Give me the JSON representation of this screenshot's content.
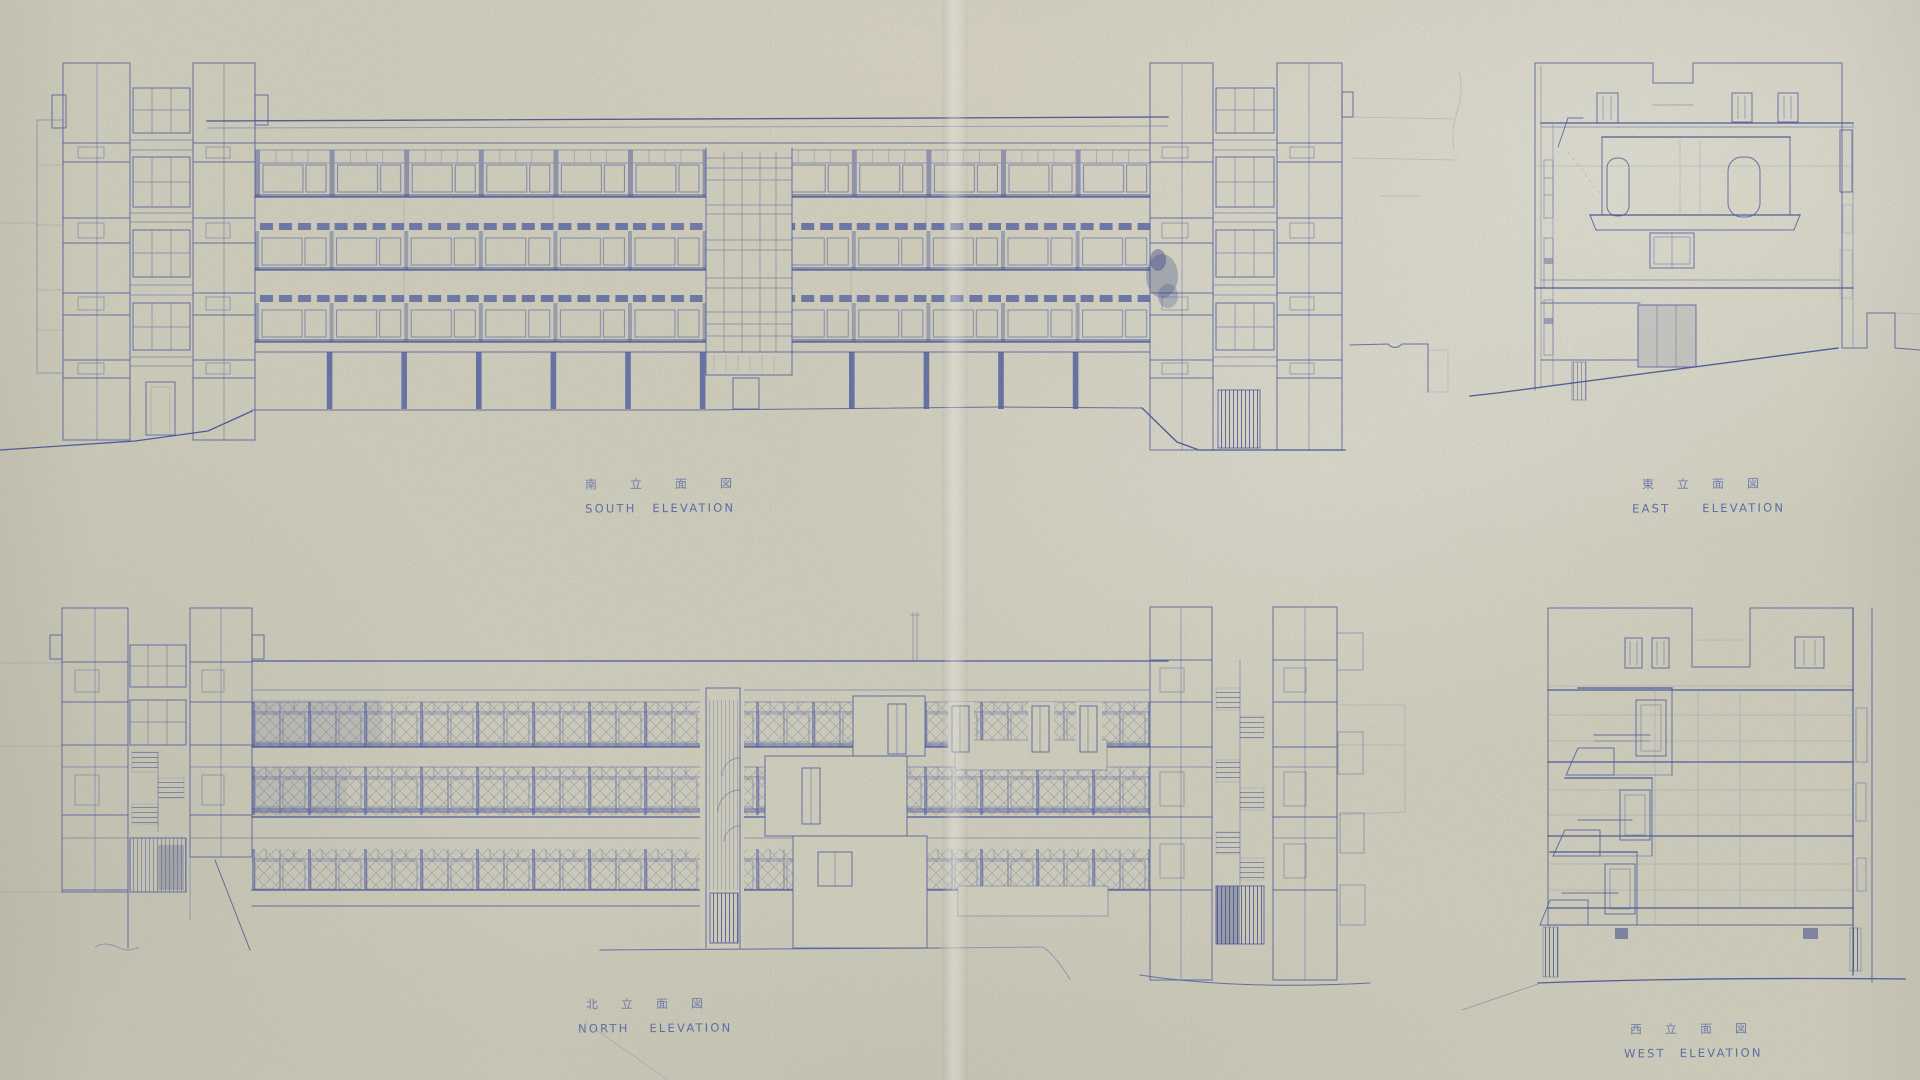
{
  "sheet": {
    "kind": "architectural elevations blueprint",
    "paper_color": "#d2cfbb",
    "ink_color": "#42509a",
    "captions": {
      "south": {
        "jp": "南立面図",
        "en": "SOUTH ELEVATION"
      },
      "east": {
        "jp": "東立面図",
        "en": "EAST ELEVATION"
      },
      "north": {
        "jp": "北立面図",
        "en": "NORTH ELEVATION"
      },
      "west": {
        "jp": "西立面図",
        "en": "WEST ELEVATION"
      }
    }
  }
}
